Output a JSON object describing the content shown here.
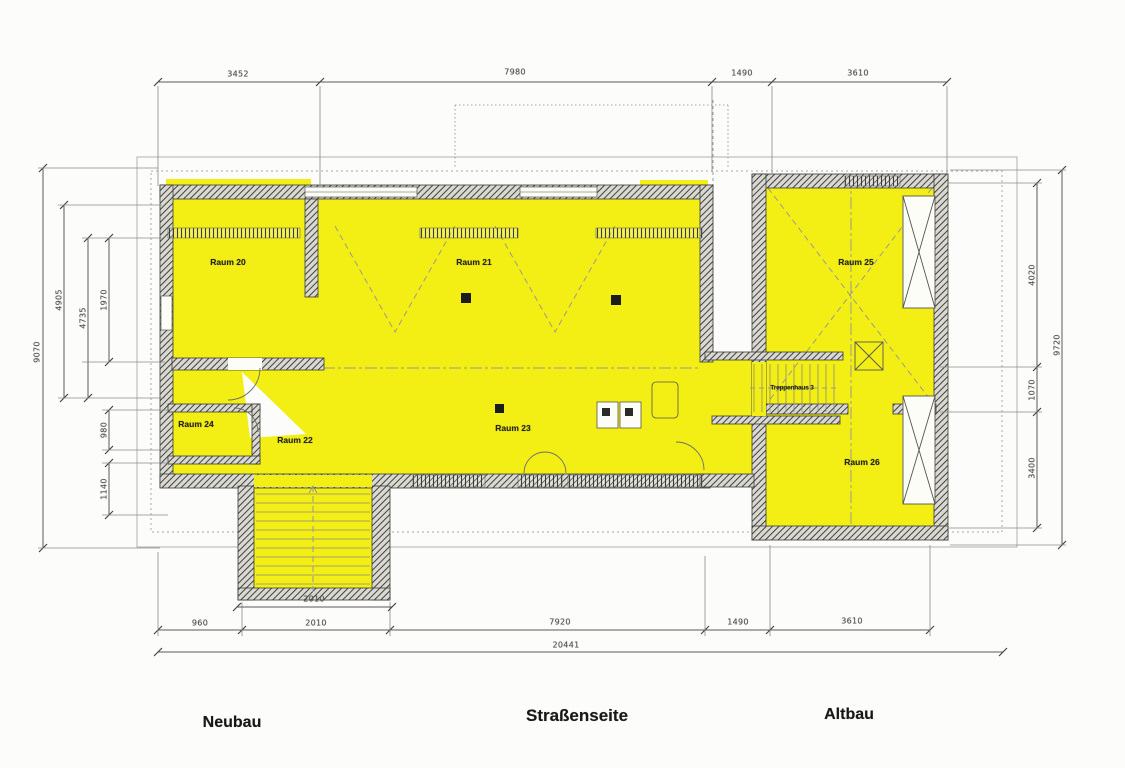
{
  "rooms": {
    "r20": "Raum 20",
    "r21": "Raum 21",
    "r22": "Raum 22",
    "r23": "Raum 23",
    "r24": "Raum 24",
    "r25": "Raum 25",
    "r26": "Raum 26",
    "stairwell": "Treppenhaus 3"
  },
  "sections": {
    "left": "Neubau",
    "center": "Straßenseite",
    "right": "Altbau"
  },
  "dims": {
    "top": [
      "3452",
      "7980",
      "1490",
      "3610"
    ],
    "bottom": [
      "960",
      "2010",
      "7920",
      "1490",
      "3610"
    ],
    "bottom_bracket": "2010",
    "bottom_total": "20441",
    "left_outer": "9070",
    "left_inner": [
      "4905",
      "4735",
      "1970"
    ],
    "left_lower": [
      "980",
      "1140"
    ],
    "right_inner": [
      "4020",
      "1070",
      "3400"
    ],
    "right_outer": "9720"
  },
  "colors": {
    "highlight": "#F3EF15",
    "wall": "#3a3a3a",
    "drawing_line": "#8a8a86",
    "dim_text": "#50504c"
  }
}
